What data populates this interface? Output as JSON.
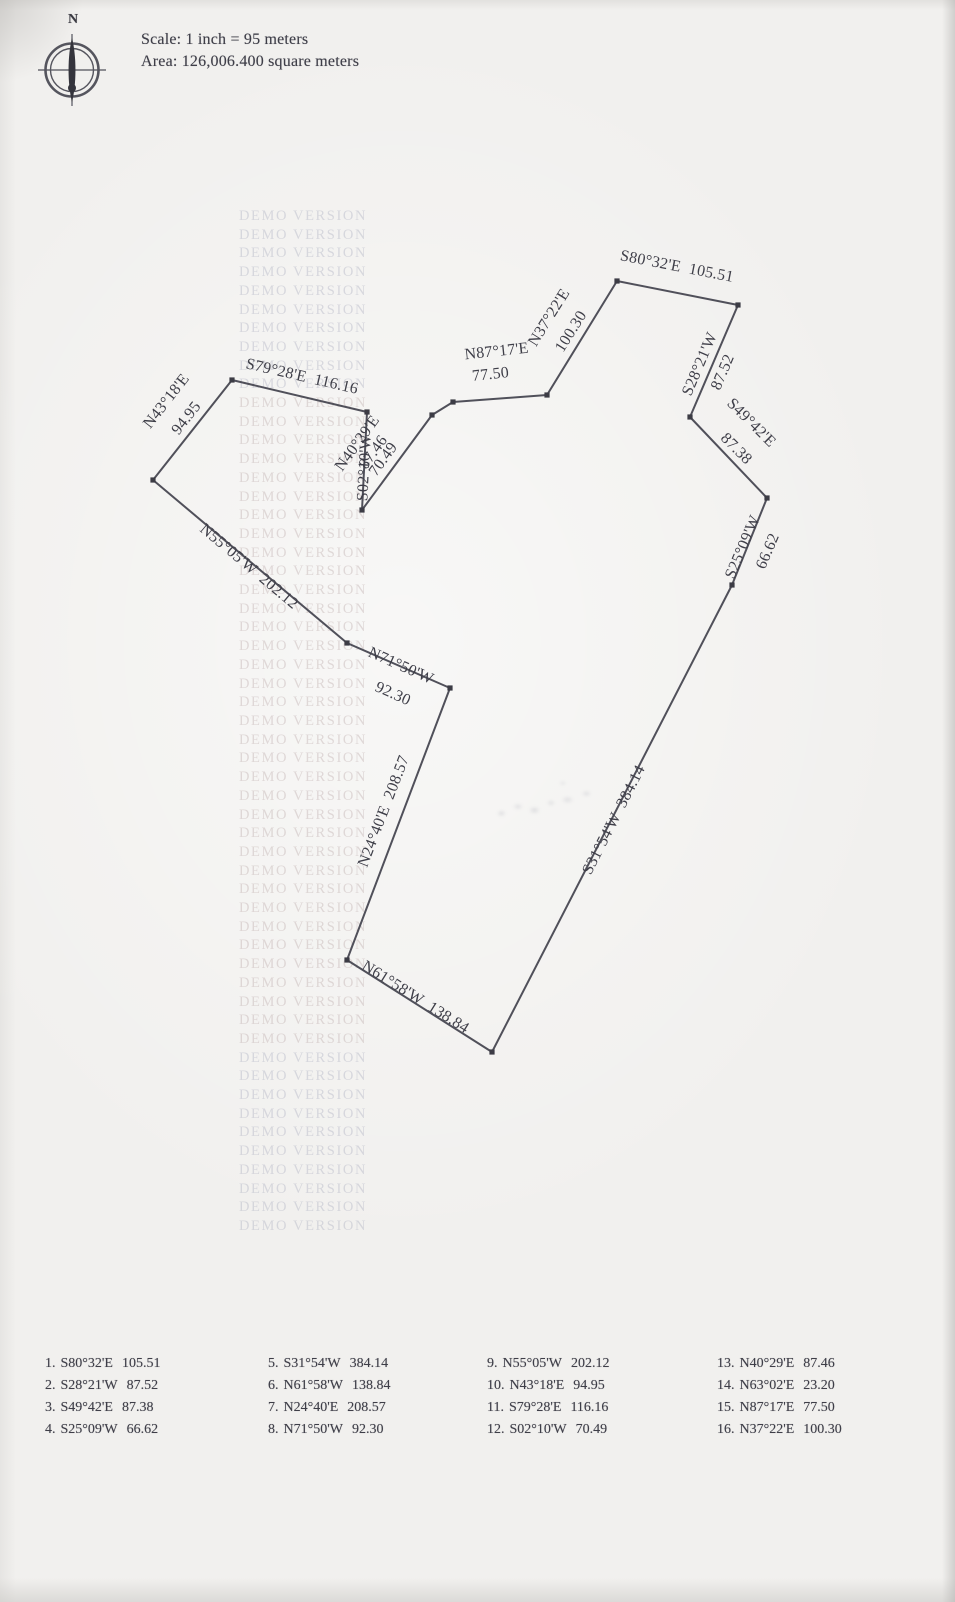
{
  "compass": {
    "north_label": "N"
  },
  "header": {
    "scale_text": "Scale: 1 inch = 95 meters",
    "area_text": "Area: 126,006.400 square meters"
  },
  "watermark": {
    "text": "DEMO VERSION"
  },
  "colors": {
    "paper": "#f1f0ee",
    "ink": "#3e3e48",
    "boundary_line": "#50505a",
    "watermark_tint": "#aaaabc"
  },
  "plot": {
    "vertices": [
      [
        617,
        281
      ],
      [
        738,
        305
      ],
      [
        690,
        417
      ],
      [
        767,
        498
      ],
      [
        732,
        585
      ],
      [
        492,
        1052
      ],
      [
        347,
        960
      ],
      [
        450,
        688
      ],
      [
        347,
        643
      ],
      [
        153,
        480
      ],
      [
        232,
        380
      ],
      [
        367,
        412
      ],
      [
        362,
        510
      ],
      [
        432,
        415
      ],
      [
        453,
        402
      ],
      [
        547,
        395
      ]
    ],
    "labels": [
      {
        "text": "S80°32'E  105.51",
        "x": 676,
        "y": 271,
        "rot": 11
      },
      {
        "text": "N37°22'E",
        "x": 553,
        "y": 320,
        "rot": -58
      },
      {
        "text": "100.30",
        "x": 575,
        "y": 334,
        "rot": -58
      },
      {
        "text": "N87°17'E",
        "x": 497,
        "y": 356,
        "rot": -6
      },
      {
        "text": "77.50",
        "x": 491,
        "y": 379,
        "rot": -6
      },
      {
        "text": "S28°21'W",
        "x": 704,
        "y": 366,
        "rot": -67
      },
      {
        "text": "87.52",
        "x": 727,
        "y": 374,
        "rot": -67
      },
      {
        "text": "S49°42'E",
        "x": 748,
        "y": 426,
        "rot": 45
      },
      {
        "text": "87.38",
        "x": 733,
        "y": 452,
        "rot": 45
      },
      {
        "text": "S25°09'W",
        "x": 747,
        "y": 549,
        "rot": -67
      },
      {
        "text": "66.62",
        "x": 772,
        "y": 553,
        "rot": -67
      },
      {
        "text": "S31°54'W  384.14",
        "x": 618,
        "y": 822,
        "rot": -63
      },
      {
        "text": "N61°58'W  138.84",
        "x": 413,
        "y": 1001,
        "rot": 32
      },
      {
        "text": "N24°40'E  208.57",
        "x": 388,
        "y": 813,
        "rot": -69
      },
      {
        "text": "N71°50'W",
        "x": 399,
        "y": 670,
        "rot": 24
      },
      {
        "text": "92.30",
        "x": 391,
        "y": 698,
        "rot": 24
      },
      {
        "text": "N55°05'W  202.12",
        "x": 246,
        "y": 570,
        "rot": 40
      },
      {
        "text": "N43°18'E",
        "x": 170,
        "y": 404,
        "rot": -52
      },
      {
        "text": "94.95",
        "x": 190,
        "y": 421,
        "rot": -52
      },
      {
        "text": "S79°28'E  116.16",
        "x": 301,
        "y": 381,
        "rot": 13
      },
      {
        "text": "N40°29'E",
        "x": 361,
        "y": 446,
        "rot": -54
      },
      {
        "text": "87.46",
        "x": 377,
        "y": 455,
        "rot": -54
      },
      {
        "text": "S02°10'W",
        "x": 369,
        "y": 468,
        "rot": -87
      },
      {
        "text": "70.49",
        "x": 387,
        "y": 462,
        "rot": -54
      }
    ]
  },
  "legend": {
    "entries": [
      {
        "n": "1.",
        "bearing": "S80°32'E",
        "distance": "105.51"
      },
      {
        "n": "2.",
        "bearing": "S28°21'W",
        "distance": "87.52"
      },
      {
        "n": "3.",
        "bearing": "S49°42'E",
        "distance": "87.38"
      },
      {
        "n": "4.",
        "bearing": "S25°09'W",
        "distance": "66.62"
      },
      {
        "n": "5.",
        "bearing": "S31°54'W",
        "distance": "384.14"
      },
      {
        "n": "6.",
        "bearing": "N61°58'W",
        "distance": "138.84"
      },
      {
        "n": "7.",
        "bearing": "N24°40'E",
        "distance": "208.57"
      },
      {
        "n": "8.",
        "bearing": "N71°50'W",
        "distance": "92.30"
      },
      {
        "n": "9.",
        "bearing": "N55°05'W",
        "distance": "202.12"
      },
      {
        "n": "10.",
        "bearing": "N43°18'E",
        "distance": "94.95"
      },
      {
        "n": "11.",
        "bearing": "S79°28'E",
        "distance": "116.16"
      },
      {
        "n": "12.",
        "bearing": "S02°10'W",
        "distance": "70.49"
      },
      {
        "n": "13.",
        "bearing": "N40°29'E",
        "distance": "87.46"
      },
      {
        "n": "14.",
        "bearing": "N63°02'E",
        "distance": "23.20"
      },
      {
        "n": "15.",
        "bearing": "N87°17'E",
        "distance": "77.50"
      },
      {
        "n": "16.",
        "bearing": "N37°22'E",
        "distance": "100.30"
      }
    ]
  }
}
